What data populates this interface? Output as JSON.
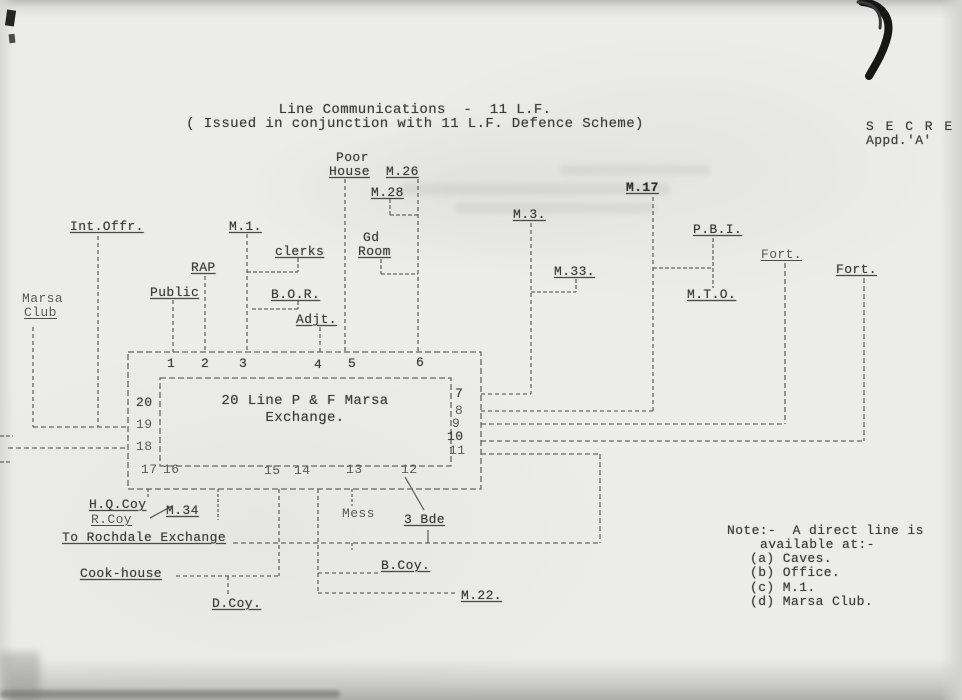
{
  "stamp": {
    "secret": "S E C R E T",
    "appd": "Appd.'A'"
  },
  "title": {
    "line1": "Line Communications  -  11 L.F.",
    "line2": "( Issued in conjunction with 11 L.F. Defence Scheme)"
  },
  "nodes": {
    "poor_line1": "Poor",
    "poor_line2": "House",
    "m26": "M.26",
    "m28": "M.28",
    "gd_line1": "Gd",
    "gd_line2": "Room",
    "int_offr": "Int.Offr.",
    "m1": "M.1.",
    "clerks": "clerks",
    "rap": "RAP",
    "public": "Public",
    "bor": "B.O.R.",
    "adjt": "Adjt.",
    "marsa_line1": "Marsa",
    "marsa_line2": "Club",
    "m3": "M.3.",
    "m33": "M.33.",
    "m17": "M.17",
    "pbi": "P.B.I.",
    "mto": "M.T.O.",
    "fort_left": "Fort.",
    "fort_right": "Fort.",
    "hq_coy": "H.Q.Coy",
    "r_coy": "R.Coy",
    "m34": "M.34",
    "rochdale": "To Rochdale Exchange",
    "cook_house": "Cook-house",
    "d_coy": "D.Coy.",
    "mess": "Mess",
    "bde": "3 Bde",
    "b_coy": "B.Coy.",
    "m22": "M.22."
  },
  "exchange": {
    "label_line1": "20 Line P & F Marsa",
    "label_line2": "Exchange.",
    "top": [
      "1",
      "2",
      "3",
      "4",
      "5",
      "6"
    ],
    "right": [
      "7",
      "8",
      "9",
      "10",
      "11"
    ],
    "bottom": [
      "17",
      "16",
      "15",
      "14",
      "13",
      "12"
    ],
    "left": [
      "20",
      "19",
      "18"
    ]
  },
  "note": {
    "line1": "Note:-  A direct line is",
    "line2": "available at:-",
    "a": "(a) Caves.",
    "b": "(b) Office.",
    "c": "(c) M.1.",
    "d": "(d) Marsa Club."
  },
  "colors": {
    "ink": "#3d3d3d",
    "paper": "#ececea"
  }
}
